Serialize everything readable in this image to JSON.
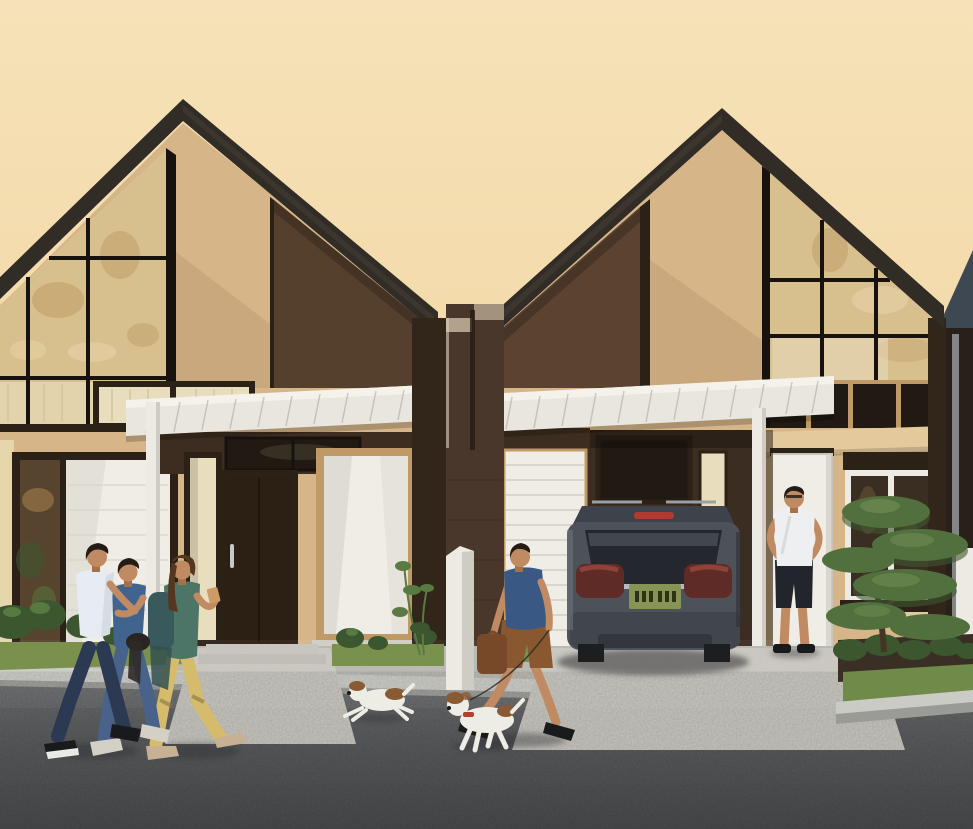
{
  "scene": {
    "type": "architectural rendering",
    "description": "Row of modern dark-gable houses at golden hour; three pedestrians walk past on the left, a man walks two small dogs, a resident stands at the right house entrance, and a gray SUV is parked in the carport.",
    "sky": "warm peach dusk sky",
    "street": "dark asphalt road with concrete sidewalk and driveways"
  },
  "palette": {
    "sky_top": "#f6e2b8",
    "sky_bottom": "#eecf98",
    "roof": "#322c26",
    "roof_hi": "#4a433b",
    "roof3": "#3e4852",
    "frame_black": "#17120d",
    "dark_frame": "#2b2117",
    "glass": "#d8bf8e",
    "glass_hi": "#ead8ae",
    "glass_ref": "#bd9c63",
    "glass_dark": "#211a12",
    "glass_int": "#3a2e22",
    "glass_int_hi": "#6b573d",
    "glass_plant": "#57442e",
    "tan": "#d6b689",
    "tan_shadow": "#b99a70",
    "tan_band": "#e3c99c",
    "tan_frame": "#c09a66",
    "brown_panel": "#55402e",
    "brown_panel2": "#5c4331",
    "brown_dark": "#32251a",
    "brown_dark2": "#3c2d20",
    "carport": "#3b2d21",
    "awning": "#e8e6df",
    "awning_hi": "#f4f2eb",
    "awning_seam": "#a9a69e",
    "white_trim": "#eceae2",
    "white_trim_shade": "#cfccc3",
    "white_door": "#efede6",
    "cream_blind": "#e8ddbd",
    "blind_line": "#cfc09a",
    "cream_siding": "#e5d6ab",
    "door": "#2c1f13",
    "brick": "#4a372b",
    "brick_cap": "#b3a28b",
    "brick_hi": "#d9cdb9",
    "slat": "#d9d6ce",
    "suv_body": "#4d5158",
    "suv_roof": "#3e424a",
    "suv_glass": "#24272d",
    "suv_glass_hi": "#5b626c",
    "suv_lower": "#41454c",
    "chrome": "#c6c9cc",
    "tail": "#5e2b27",
    "tail_hi": "#8f4238",
    "brake": "#b23a30",
    "plate": "#879455",
    "plate_text": "#2d3317",
    "wheel": "#1c1e20",
    "suv_hi": "#6d737a",
    "sidewalk": "#b7b6b0",
    "driveway": "#c7c5be",
    "curb": "#9a9b97",
    "curb_hi": "#cbcbc6",
    "road": "#595b5d",
    "road_dark": "#47494b",
    "road_hi": "#696b6d",
    "grass": "#7a914e",
    "grass2": "#6f8a49",
    "bush": "#3c5630",
    "bush_hi": "#577a40",
    "mulch": "#3a2f24",
    "leaf": "#52703e",
    "leaf_dark": "#3e5730",
    "leaf_hi": "#6e8b50",
    "trunk": "#453526",
    "plant": "#5a7a43",
    "skin": "#c08a63",
    "skin_shade": "#a5714b",
    "hair": "#241c15",
    "hair_brown": "#55371f",
    "tee_white": "#e7ecf2",
    "tee_blue": "#40648e",
    "tee_navy": "#395984",
    "jeans_dark": "#2b3952",
    "jeans_blue": "#48628a",
    "jacket": "#4c7568",
    "backpack": "#39595d",
    "pants_yellow": "#d5bc6d",
    "shorts_brown": "#8a5830",
    "shorts_dark": "#22252c",
    "shirt_white": "#edeff0",
    "shoe_dark": "#191a1c",
    "shoe_light": "#d4d0c6",
    "sole": "#e9e9e5",
    "flat_beige": "#c7b193",
    "dog_white": "#edece5",
    "dog_brown": "#8a5a33",
    "collar_red": "#b33f2d",
    "bag": "#784928",
    "shadow": "#2d2f31",
    "pipe": "#92969a",
    "wall3": "#2a201a",
    "step": "#c5c3bc"
  },
  "objects": {
    "house_left": {
      "label": "Left house: dark gable roof, triangular glazed gable, white entry canopy, dark wood front door"
    },
    "house_right": {
      "label": "Right house: dark gable roof, glazed gable, carport with white roller door and parked SUV"
    },
    "house_far_right": {
      "label": "Partially visible third house at right edge"
    },
    "divider_wall": {
      "label": "Dark brick party wall between the houses"
    },
    "street_pillar": {
      "label": "White masonry pillar at the kerb"
    },
    "suv": {
      "label": "Gray SUV parked in the carport",
      "plate": "green license plate, characters illegible"
    },
    "pedestrians": {
      "label": "Three people walking together past the left house"
    },
    "dog_walker": {
      "label": "Man in navy shirt and brown shorts walking two dogs"
    },
    "dogs": {
      "label": "Two small white-and-brown dogs"
    },
    "resident": {
      "label": "Man in white shirt standing at the right house entrance"
    },
    "tree": {
      "label": "Layered ornamental tree in the front garden"
    },
    "vegetation": {
      "label": "Low shrubs and grass strips along the facades"
    }
  }
}
